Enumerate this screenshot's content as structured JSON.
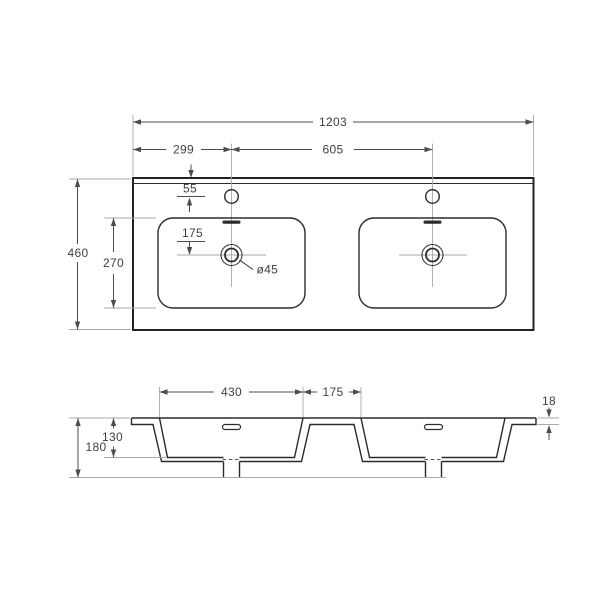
{
  "drawing": {
    "title": "double-washbasin-technical-drawing",
    "top_view": {
      "overall_width": "1203",
      "left_faucet_offset": "299",
      "faucet_spacing": "605",
      "faucet_from_edge": "55",
      "faucet_to_drain": "175",
      "basin_length": "270",
      "overall_depth": "460",
      "drain_diameter": "ø45"
    },
    "section_view": {
      "basin_width": "430",
      "basin_gap": "175",
      "edge_thickness": "18",
      "basin_depth": "130",
      "overall_height": "180"
    }
  }
}
